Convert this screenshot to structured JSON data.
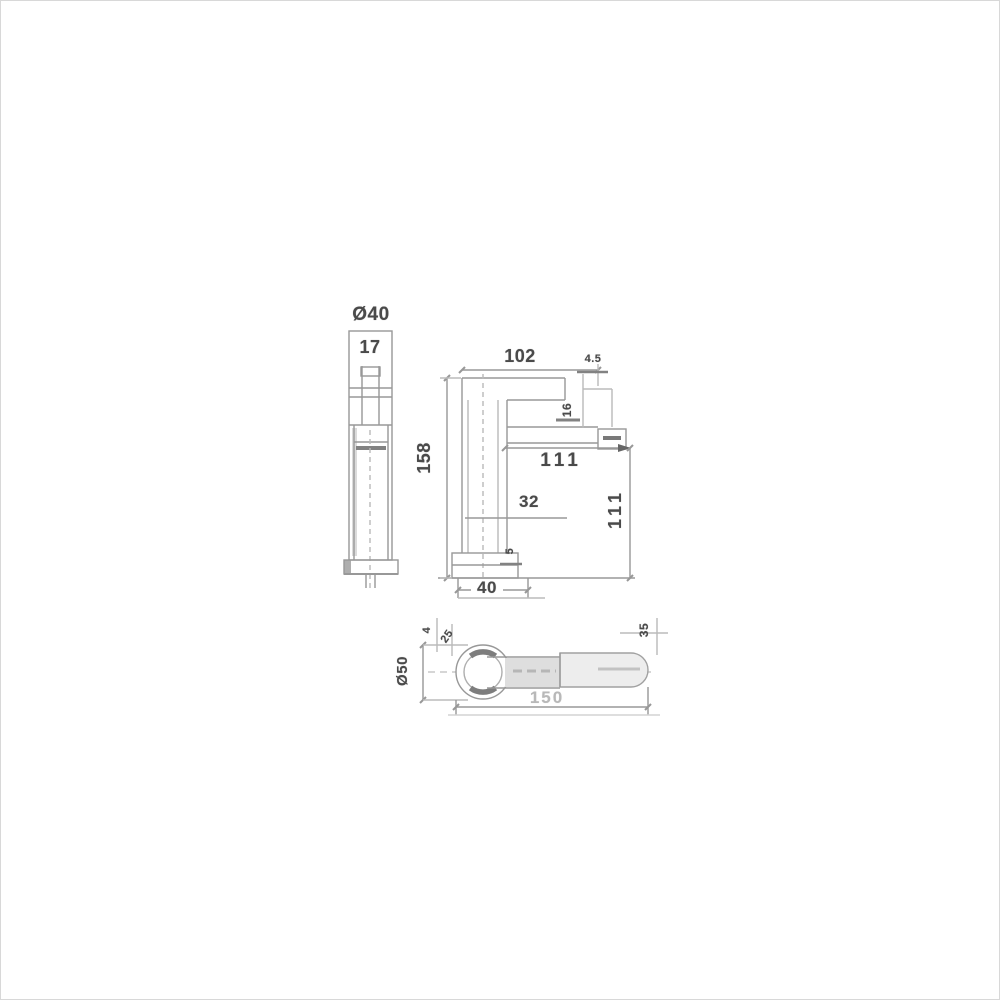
{
  "drawing": {
    "type": "faucet-basin-mixer-technical-drawing",
    "front_view": {
      "diameter": "Ø40",
      "dim_17": "17"
    },
    "side_view": {
      "dim_102": "102",
      "dim_4_5": "4.5",
      "dim_16": "16",
      "dim_158": "158",
      "dim_111_horizontal": "111",
      "dim_32": "32",
      "dim_111_vertical": "111",
      "dim_5": "5",
      "dim_40": "40"
    },
    "plan_view": {
      "diameter": "Ø50",
      "dim_4": "4",
      "dim_25": "25",
      "dim_35": "35",
      "dim_150": "150"
    },
    "colors": {
      "line": "#909090",
      "text": "#4a4a4a",
      "light_text": "#b8b8b8",
      "background": "#ffffff"
    }
  }
}
